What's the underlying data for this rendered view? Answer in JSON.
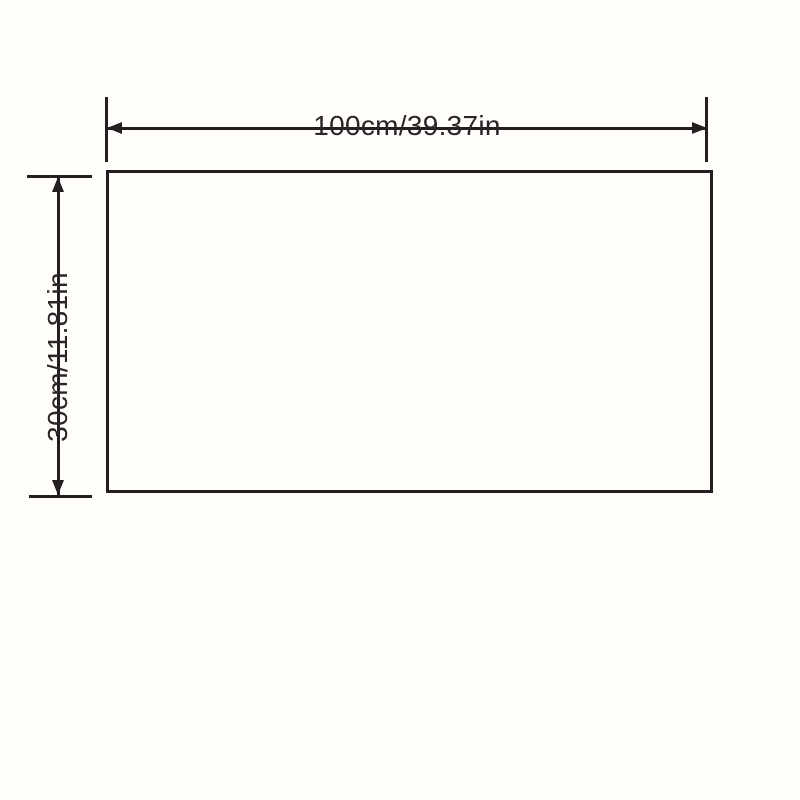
{
  "diagram": {
    "type": "product-dimension-diagram",
    "width_dimension": {
      "label": "100cm/39.37in",
      "value_cm": 100,
      "value_in": 39.37
    },
    "height_dimension": {
      "label": "30cm/11.81in",
      "value_cm": 30,
      "value_in": 11.81
    },
    "colors": {
      "background": "#fffefa",
      "line": "#231f20",
      "text": "#2a2527"
    }
  }
}
